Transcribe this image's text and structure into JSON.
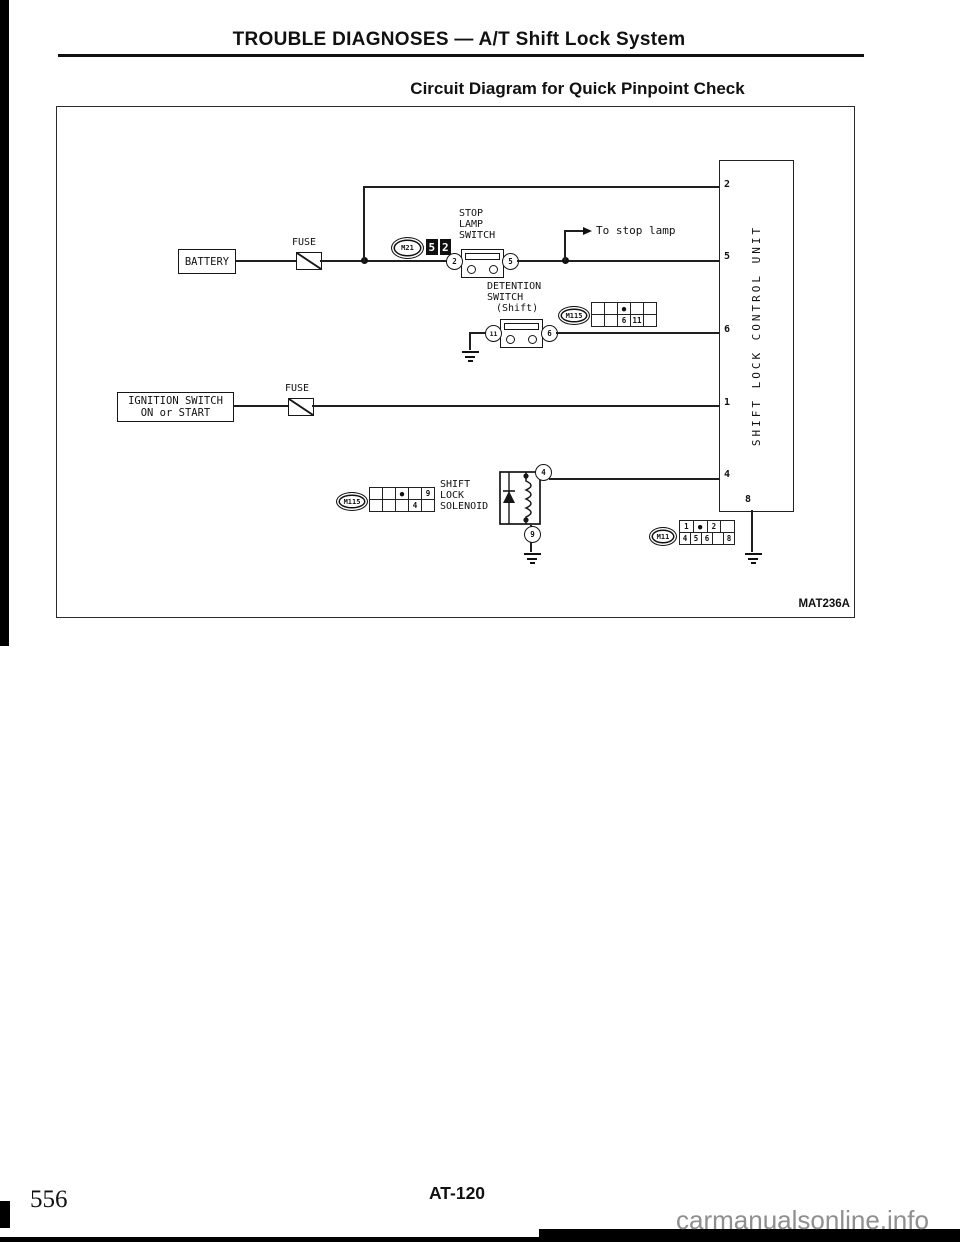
{
  "page": {
    "header_title": "TROUBLE DIAGNOSES — A/T Shift Lock System",
    "diagram_title": "Circuit Diagram for Quick Pinpoint Check",
    "figure_code": "MAT236A",
    "page_code": "AT-120",
    "page_number": "556",
    "watermark": "carmanualsonline.info"
  },
  "diagram": {
    "battery": {
      "label": "BATTERY"
    },
    "fuse_battery": {
      "label": "FUSE"
    },
    "fuse_ignition": {
      "label": "FUSE"
    },
    "ignition_switch": {
      "line1": "IGNITION SWITCH",
      "line2": "ON or START"
    },
    "stop_lamp_switch": {
      "line1": "STOP",
      "line2": "LAMP",
      "line3": "SWITCH",
      "terminal_left": "2",
      "terminal_right": "5"
    },
    "to_stop_lamp_label": "To stop lamp",
    "detention_switch": {
      "line1": "DETENTION",
      "line2": "SWITCH",
      "line3": "(Shift)",
      "terminal_left": "11",
      "terminal_right": "6"
    },
    "solenoid": {
      "line1": "SHIFT",
      "line2": "LOCK",
      "line3": "SOLENOID",
      "terminal_top": "4",
      "terminal_bottom": "9"
    },
    "control_unit": {
      "label": "SHIFT LOCK CONTROL UNIT",
      "terminal_2": "2",
      "terminal_5": "5",
      "terminal_6": "6",
      "terminal_1": "1",
      "terminal_4": "4",
      "terminal_8": "8"
    },
    "connectors": {
      "m21": {
        "name": "M21",
        "code_cells": [
          "5",
          "2"
        ]
      },
      "m115_detention": {
        "name": "M115",
        "grid": [
          [
            "",
            "",
            "●",
            "",
            ""
          ],
          [
            "",
            "",
            "6",
            "11",
            ""
          ]
        ]
      },
      "m115_solenoid": {
        "name": "M115",
        "grid": [
          [
            "",
            "",
            "●",
            "",
            "9"
          ],
          [
            "",
            "",
            "",
            "4",
            ""
          ]
        ]
      },
      "m11": {
        "name": "M11",
        "grid": [
          [
            "1",
            "●",
            "2",
            ""
          ],
          [
            "4",
            "5",
            "6",
            "",
            "8"
          ]
        ]
      }
    },
    "colors": {
      "ink": "#1a1a1a",
      "paper": "#ffffff",
      "watermark_gray": "#8f8f8f"
    }
  }
}
